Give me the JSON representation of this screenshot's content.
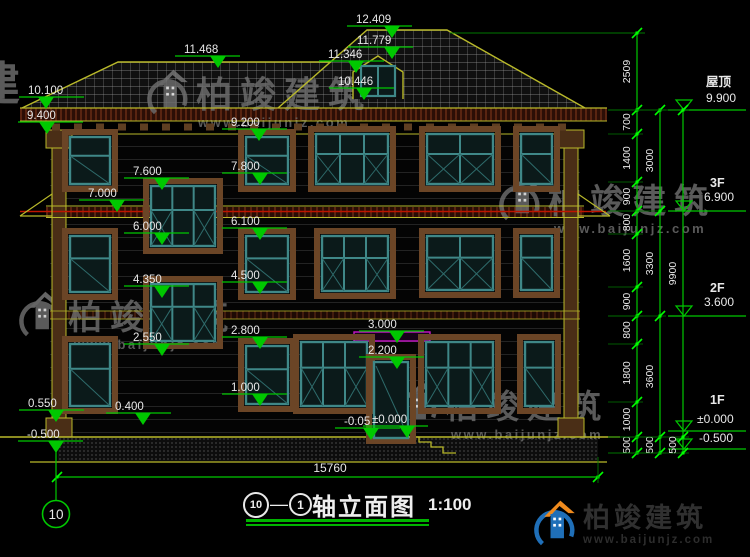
{
  "title_block": {
    "axis_from": "10",
    "separator": "—",
    "axis_to": "1",
    "name": "轴立面图",
    "scale": "1:100"
  },
  "brand": {
    "name": "柏竣建筑",
    "url": "www.baijunjz.com"
  },
  "axis_bubble": {
    "label": "10"
  },
  "total_width": {
    "label": "15760"
  },
  "colors": {
    "dim_green": "#00c800",
    "outline_yellow": "#b9b92a",
    "floor_red": "#be1400",
    "canopy_magenta": "#c816c8",
    "window_teal": "#3f8888",
    "trim_brown": "#6b4526",
    "text_white": "#e8e8e8",
    "watermark_gray": "#6e6e6e",
    "brand_blue": "#1f6fb8",
    "brand_orange": "#ef8a1d"
  },
  "levels_left": [
    {
      "v": "12.409",
      "x": 356,
      "y": 12,
      "tx": 392
    },
    {
      "v": "11.779",
      "x": 357,
      "y": 33,
      "tx": 392
    },
    {
      "v": "11.468",
      "x": 184,
      "y": 42,
      "tx": 218
    },
    {
      "v": "11.346",
      "x": 328,
      "y": 47,
      "tx": 356
    },
    {
      "v": "10.446",
      "x": 338,
      "y": 74,
      "tx": 364
    },
    {
      "v": "10.100",
      "x": 28,
      "y": 83,
      "tx": 46
    },
    {
      "v": "9.400",
      "x": 27,
      "y": 108,
      "tx": 47
    },
    {
      "v": "9.200",
      "x": 231,
      "y": 115,
      "tx": 259
    },
    {
      "v": "7.800",
      "x": 231,
      "y": 159,
      "tx": 260
    },
    {
      "v": "7.600",
      "x": 133,
      "y": 164,
      "tx": 162
    },
    {
      "v": "7.000",
      "x": 88,
      "y": 186,
      "tx": 117
    },
    {
      "v": "6.100",
      "x": 231,
      "y": 214,
      "tx": 260
    },
    {
      "v": "6.000",
      "x": 133,
      "y": 219,
      "tx": 162
    },
    {
      "v": "4.500",
      "x": 231,
      "y": 268,
      "tx": 260
    },
    {
      "v": "4.350",
      "x": 133,
      "y": 272,
      "tx": 162
    },
    {
      "v": "3.000",
      "x": 368,
      "y": 317,
      "tx": 397
    },
    {
      "v": "2.800",
      "x": 231,
      "y": 323,
      "tx": 260
    },
    {
      "v": "2.550",
      "x": 133,
      "y": 330,
      "tx": 162
    },
    {
      "v": "2.200",
      "x": 368,
      "y": 343,
      "tx": 397
    },
    {
      "v": "1.000",
      "x": 231,
      "y": 380,
      "tx": 260
    },
    {
      "v": "0.550",
      "x": 28,
      "y": 396,
      "tx": 56
    },
    {
      "v": "0.400",
      "x": 115,
      "y": 399,
      "tx": 143
    },
    {
      "v": "-0.05",
      "x": 344,
      "y": 414,
      "tx": 371
    },
    {
      "v": "±0.000",
      "x": 372,
      "y": 412,
      "tx": 407
    },
    {
      "v": "-0.500",
      "x": 27,
      "y": 427,
      "tx": 56
    }
  ],
  "levels_right": [
    {
      "name": "屋顶",
      "value": "9.900",
      "nx": 706,
      "ny": 86,
      "vx": 706,
      "vy": 102,
      "ly": 110
    },
    {
      "name": "3F",
      "value": "6.900",
      "nx": 710,
      "ny": 187,
      "vx": 704,
      "vy": 201,
      "ly": 211
    },
    {
      "name": "2F",
      "value": "3.600",
      "nx": 710,
      "ny": 292,
      "vx": 704,
      "vy": 306,
      "ly": 316
    },
    {
      "name": "1F",
      "value": "±0.000",
      "nx": 710,
      "ny": 404,
      "vx": 697,
      "vy": 423,
      "ly": 431
    },
    {
      "name": "",
      "value": "-0.500",
      "nx": 0,
      "ny": 0,
      "vx": 699,
      "vy": 442,
      "ly": 449
    }
  ],
  "dim_chains": [
    {
      "x": 637,
      "ticks": [
        33,
        110,
        134,
        182,
        211,
        234,
        287,
        316,
        344,
        402,
        437,
        453
      ],
      "labels": [
        "2509",
        "700",
        "1400",
        "900",
        "800",
        "1600",
        "900",
        "800",
        "1800",
        "1000",
        "500"
      ]
    },
    {
      "x": 660,
      "ticks": [
        110,
        211,
        316,
        437,
        453
      ],
      "labels": [
        "3000",
        "3300",
        "3600",
        "500"
      ]
    },
    {
      "x": 683,
      "ticks": [
        110,
        437,
        453
      ],
      "labels": [
        "9900",
        "500"
      ]
    }
  ],
  "windows": [
    {
      "x": 70,
      "y": 137,
      "w": 40,
      "h": 47,
      "c": 1
    },
    {
      "x": 246,
      "y": 137,
      "w": 42,
      "h": 47,
      "c": 1
    },
    {
      "x": 316,
      "y": 134,
      "w": 72,
      "h": 50,
      "c": 3
    },
    {
      "x": 427,
      "y": 134,
      "w": 66,
      "h": 50,
      "c": 2
    },
    {
      "x": 521,
      "y": 134,
      "w": 31,
      "h": 50,
      "c": 1
    },
    {
      "x": 151,
      "y": 186,
      "w": 64,
      "h": 60,
      "c": 3
    },
    {
      "x": 151,
      "y": 284,
      "w": 64,
      "h": 57,
      "c": 3
    },
    {
      "x": 70,
      "y": 236,
      "w": 40,
      "h": 56,
      "c": 1
    },
    {
      "x": 246,
      "y": 236,
      "w": 42,
      "h": 56,
      "c": 1
    },
    {
      "x": 322,
      "y": 236,
      "w": 66,
      "h": 55,
      "c": 3
    },
    {
      "x": 427,
      "y": 236,
      "w": 66,
      "h": 54,
      "c": 2
    },
    {
      "x": 521,
      "y": 236,
      "w": 31,
      "h": 54,
      "c": 1
    },
    {
      "x": 70,
      "y": 344,
      "w": 40,
      "h": 62,
      "c": 1
    },
    {
      "x": 246,
      "y": 346,
      "w": 42,
      "h": 58,
      "c": 1
    },
    {
      "x": 301,
      "y": 342,
      "w": 66,
      "h": 64,
      "c": 3
    },
    {
      "x": 426,
      "y": 342,
      "w": 67,
      "h": 64,
      "c": 3
    },
    {
      "x": 525,
      "y": 342,
      "w": 28,
      "h": 64,
      "c": 1
    }
  ],
  "door": {
    "x": 374,
    "y": 362,
    "w": 34,
    "h": 76
  },
  "dormer_window": {
    "x": 361,
    "y": 66,
    "w": 34,
    "h": 30
  },
  "watermarks": [
    {
      "x": -26,
      "y": 48,
      "size": 46,
      "text": "建",
      "url": "",
      "logo": false,
      "indent": 0
    },
    {
      "x": 146,
      "y": 66,
      "size": 36,
      "text": "柏竣建筑",
      "url": "www.baijunjz.com",
      "logo": true,
      "indent": 52
    },
    {
      "x": 498,
      "y": 172,
      "size": 34,
      "text": "柏竣建筑",
      "url": "www.baijunjz.com",
      "logo": true,
      "indent": 56
    },
    {
      "x": 18,
      "y": 288,
      "size": 34,
      "text": "柏竣建筑",
      "url": "www.baijunjz.com",
      "logo": true,
      "indent": 56
    },
    {
      "x": 395,
      "y": 378,
      "size": 33,
      "text": "柏竣建筑",
      "url": "www.baijunjz.com",
      "logo": true,
      "indent": 56
    }
  ]
}
